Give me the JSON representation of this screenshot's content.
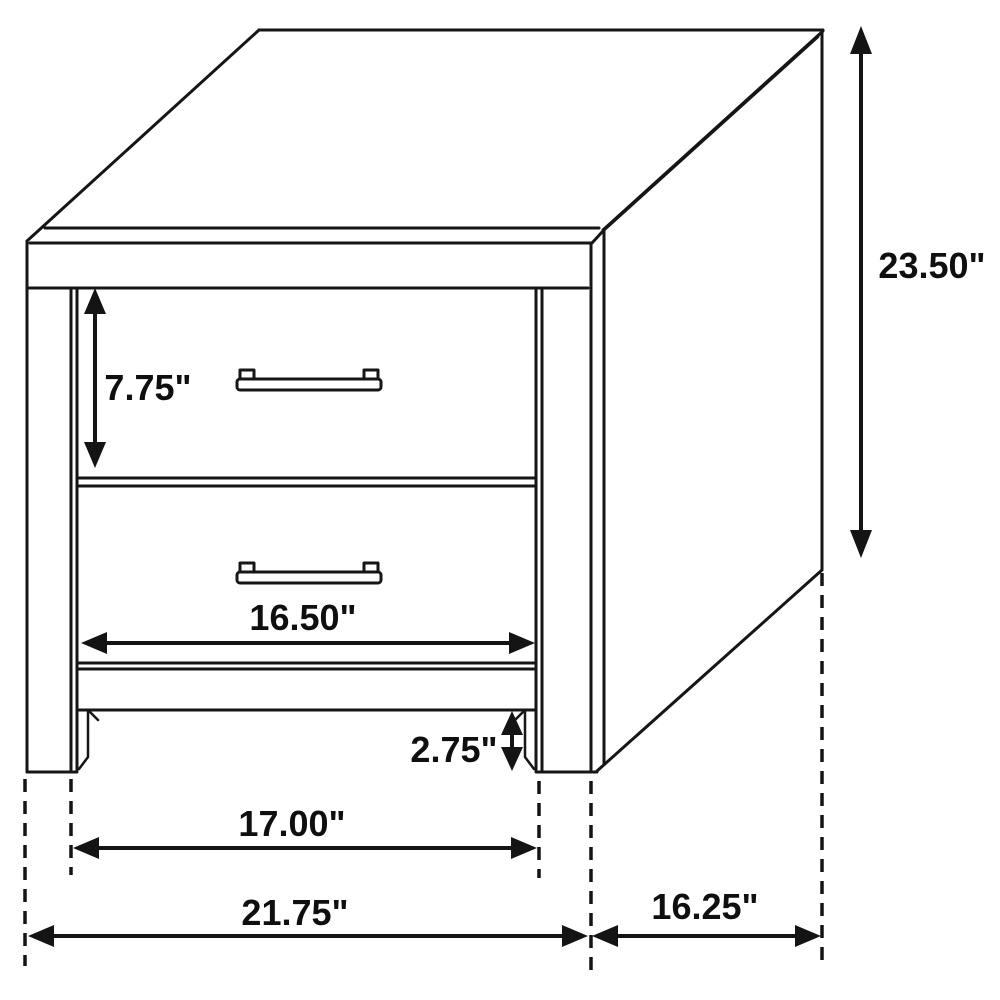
{
  "diagram": {
    "background_color": "#ffffff",
    "line_color": "#161616",
    "label_color": "#0f0f0f",
    "labels": {
      "drawer_height": "7.75\"",
      "overall_height": "23.50\"",
      "drawer_width": "16.50\"",
      "base_height": "2.75\"",
      "leg_span_width": "17.00\"",
      "overall_width": "21.75\"",
      "depth": "16.25\""
    }
  }
}
